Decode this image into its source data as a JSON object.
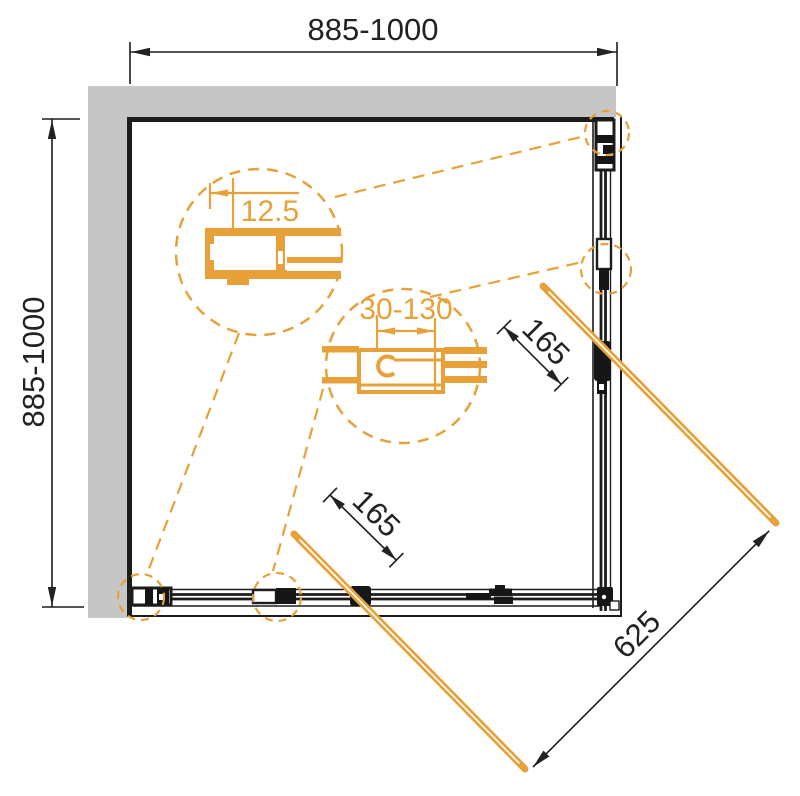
{
  "drawing": {
    "dimensions": {
      "top_width": "885-1000",
      "left_depth": "885-1000",
      "wall_profile_adjust": "12.5",
      "connector_adjust": "30-130",
      "handle_right": "165",
      "handle_bottom": "165",
      "entry_diagonal": "625"
    },
    "colors": {
      "accent_orange": "#E7A138",
      "wall_gray": "#C6C6C6",
      "line_black": "#1C1C1C"
    }
  }
}
